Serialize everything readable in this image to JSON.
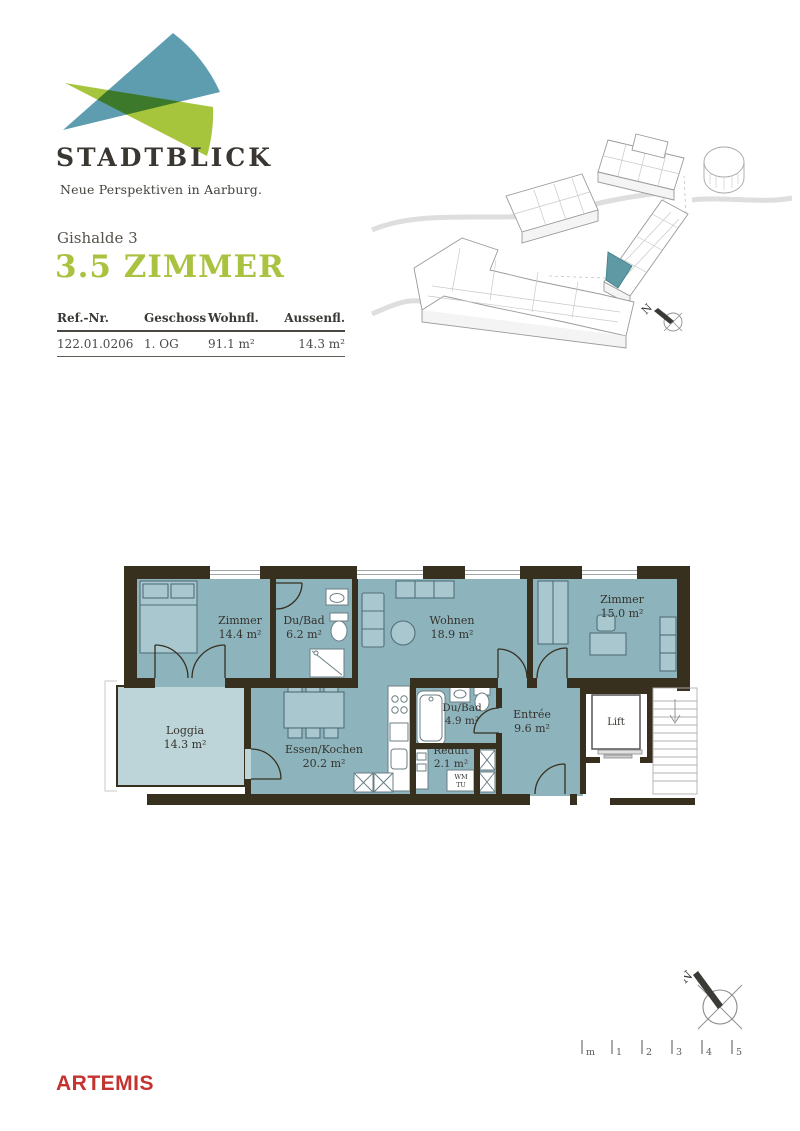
{
  "brand": {
    "name": "STADTBLICK",
    "tagline": "Neue Perspektiven in Aarburg."
  },
  "project": {
    "location": "Gishalde 3",
    "title": "3.5 ZIMMER"
  },
  "unit_table": {
    "headers": [
      "Ref.-Nr.",
      "Geschoss",
      "Wohnfl.",
      "Aussenfl."
    ],
    "row": [
      "122.01.0206",
      "1. OG",
      "91.1 m²",
      "14.3 m²"
    ]
  },
  "floor_plan": {
    "rooms": [
      {
        "name": "Zimmer",
        "area": "14.4 m²"
      },
      {
        "name": "Du/Bad",
        "area": "6.2 m²"
      },
      {
        "name": "Wohnen",
        "area": "18.9 m²"
      },
      {
        "name": "Zimmer",
        "area": "15.0 m²"
      },
      {
        "name": "Loggia",
        "area": "14.3 m²"
      },
      {
        "name": "Essen/Kochen",
        "area": "20.2 m²"
      },
      {
        "name": "Du/Bad",
        "area": "4.9 m²"
      },
      {
        "name": "Reduit",
        "area": "2.1 m²"
      },
      {
        "name": "Entrée",
        "area": "9.6 m²"
      },
      {
        "name": "Lift",
        "area": ""
      }
    ],
    "appliances": {
      "wm": "WM",
      "tu": "TU"
    }
  },
  "site_plan": {
    "compass_label": "N"
  },
  "compass": {
    "label": "N"
  },
  "scale_bar": {
    "labels": [
      "m",
      "1",
      "2",
      "3",
      "4",
      "5"
    ]
  },
  "footer": {
    "brand": "ARTEMIS"
  },
  "colors": {
    "title_green": "#A9C23F",
    "logo_teal": "#5E9DB0",
    "logo_green": "#A6C43C",
    "plan_wall": "#37301F",
    "plan_room": "#8DB3BD",
    "plan_loggia": "#BDD4D8",
    "highlight_teal": "#5F99A3",
    "artemis_red": "#C4332F"
  }
}
